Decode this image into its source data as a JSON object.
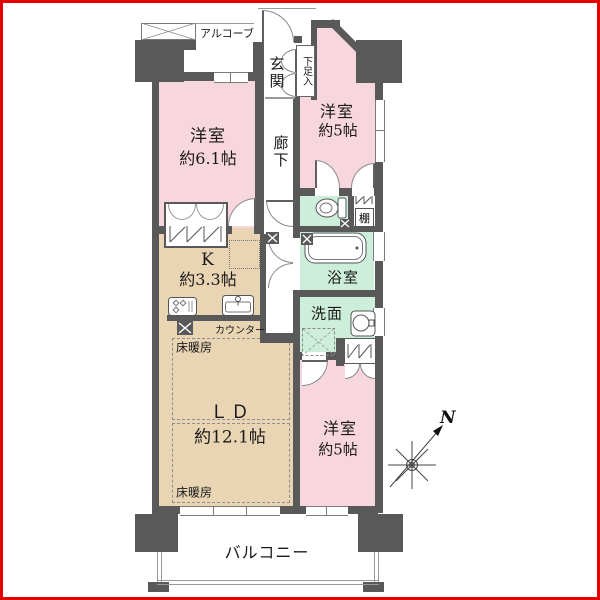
{
  "rooms": {
    "bedroom_nw": {
      "label": "洋室",
      "size": "約6.1帖"
    },
    "bedroom_ne": {
      "label": "洋室",
      "size": "約5帖"
    },
    "bedroom_se": {
      "label": "洋室",
      "size": "約5帖"
    },
    "living_dining": {
      "label": "ＬＤ",
      "size": "約12.1帖"
    },
    "kitchen": {
      "label": "K",
      "size": "約3.3帖"
    },
    "bathroom": {
      "label": "浴室"
    },
    "washroom": {
      "label": "洗面"
    },
    "entrance": {
      "label": "玄関"
    },
    "hallway": {
      "label": "廊下"
    },
    "balcony": {
      "label": "バルコニー"
    },
    "alcove": {
      "label": "アルコーブ"
    }
  },
  "annotations": {
    "floor_heating": "床暖房",
    "counter": "カウンター",
    "shelf": "棚",
    "shoe_box": "下足入",
    "north": "N"
  },
  "colors": {
    "frame": "#e60000",
    "wall": "#595959",
    "bedroom_fill": "#f8d6de",
    "ldk_fill": "#e9d5b4",
    "wet_fill": "#cdeeda",
    "text": "#1a1a1a"
  }
}
